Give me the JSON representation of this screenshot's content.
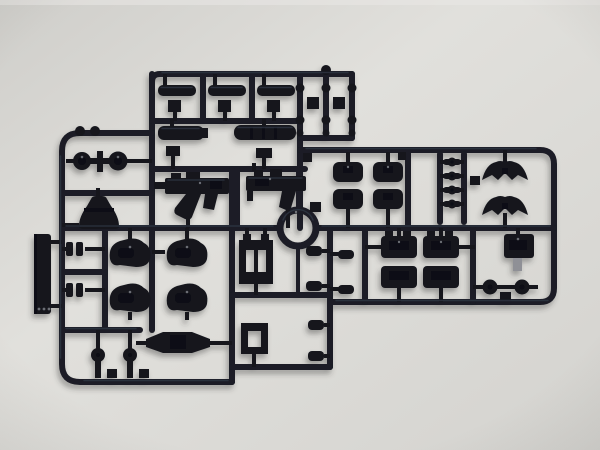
{
  "scene": {
    "description": "Photograph of a black injection-molded model-kit parts sprue (runner) lying on a plain light-gray surface",
    "object": "plastic runner with unassembled mecha model parts",
    "surface": "light gray paper background"
  },
  "colors": {
    "bg_corner": "#cfceca",
    "bg_light": "#e1e0dc",
    "bg_dark": "#d4d3cf",
    "edge_light": "#e9e8e5",
    "vignette": "#6f6e6a",
    "plastic_rail": "#1a1d25",
    "plastic_part": "#13161e",
    "plastic_highlight": "#343948",
    "plastic_deep": "#0a0c12",
    "gray_peg": "#8f9096",
    "speck": "#7c7e84",
    "shadow": "#3a3a38"
  },
  "parts": {
    "ring_joint": "circular ring part",
    "smg_a": "submachine gun (left)",
    "smg_b": "submachine gun (right)",
    "barrels": "three small barrel parts",
    "large_cylinders": "two large cylinder parts",
    "knob_grid": "grid of small round knobs",
    "knee_joints": "four knee joint blocks",
    "peg_column": "column of four pegs",
    "soles": "two winged sole parts",
    "armor_blocks": "four armor block parts",
    "backpack_block": "block part with gray polycap peg",
    "round_joints": "two round joint caps",
    "blade_plate": "flat blade plate",
    "clips": "two small clip parts",
    "shoulders": "four shoulder armor lumps",
    "pins": "two round-head pin parts",
    "winged_fin": "winged fin part",
    "torso_frame": "torso frame part",
    "square_ring": "square ring part",
    "hip_skirt": "flared skirt part",
    "ball_joints": "two ball joints with cross link",
    "small_cylinders": "small cylinder parts"
  }
}
